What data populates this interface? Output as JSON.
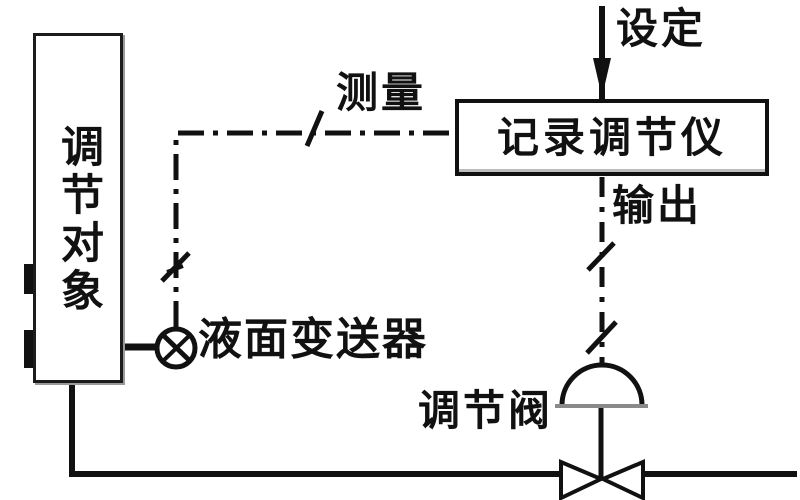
{
  "diagram": {
    "type": "control-loop-block-diagram",
    "background_color": "#ffffff",
    "ink_color": "#111111",
    "boxes": {
      "controlled_object": {
        "label": "调节对象",
        "text_orientation": "vertical"
      },
      "controller": {
        "label": "记录调节仪"
      }
    },
    "labels": {
      "setpoint": "设定",
      "measurement": "测量",
      "output": "输出",
      "control_valve": "调节阀",
      "level_transmitter": "液面变送器"
    },
    "icons": {
      "transmitter": "circle-with-diagonal-cross",
      "valve_actuator": "dome",
      "valve_body": "bowtie",
      "setpoint_arrow": "arrow-down"
    },
    "connections": [
      {
        "from": "调节对象",
        "via": "液面变送器",
        "to": "记录调节仪",
        "label": "测量",
        "style": "dash-dot-signal-with-ticks"
      },
      {
        "from": "设定",
        "to": "记录调节仪",
        "style": "solid-line-arrow-down"
      },
      {
        "from": "记录调节仪",
        "to": "调节阀",
        "label": "输出",
        "style": "dashed-signal-with-ticks"
      },
      {
        "from": "调节阀",
        "to": "调节对象",
        "style": "solid-pipe"
      }
    ]
  }
}
